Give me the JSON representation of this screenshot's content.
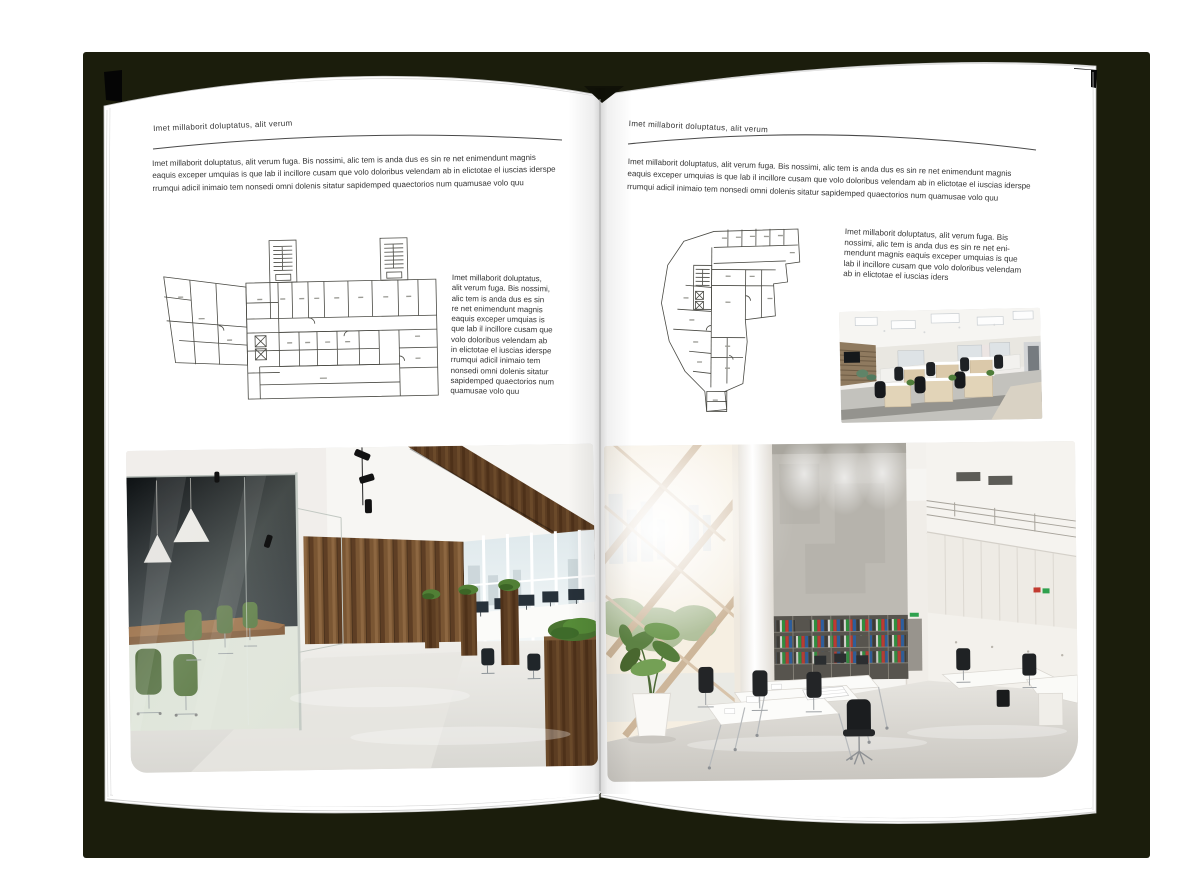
{
  "document": {
    "type": "magazine-spread-mockup",
    "backdrop_color": "#1b1d0c",
    "page_color": "#ffffff"
  },
  "left_page": {
    "kicker": "Imet millaborit doluptatus, alit verum",
    "intro_lines": [
      "Imet millaborit doluptatus, alit verum fuga. Bis nossimi, alic tem is anda dus es sin re net enimendunt magnis",
      "eaquis exceper umquias is que lab il incillore cusam que volo doloribus velendam ab in elictotae el iuscias iderspe",
      "rrumqui adicil inimaio tem nonsedi omni dolenis sitatur sapidemped quaectorios num quamusae volo quu"
    ],
    "side_lines": [
      "Imet millaborit doluptatus,",
      "alit verum fuga. Bis nossimi,",
      "alic tem is anda dus es sin",
      "re net enimendunt magnis",
      "eaquis exceper umquias is",
      "que lab il incillore cusam que",
      "volo doloribus velendam ab",
      "in elictotae el iuscias iderspe",
      "rrumqui adicil inimaio tem",
      "nonsedi omni dolenis sitatur",
      "sapidemped quaectorios num",
      "quamusae volo quu"
    ]
  },
  "right_page": {
    "kicker": "Imet millaborit doluptatus, alit verum",
    "intro_lines": [
      "Imet millaborit doluptatus, alit verum fuga. Bis nossimi, alic tem is anda dus es sin re net enimendunt magnis",
      "eaquis exceper umquias is que lab il incillore cusam que volo doloribus velendam ab in elictotae el iuscias iderspe",
      "rrumqui adicil inimaio tem nonsedi omni dolenis sitatur sapidemped quaectorios num quamusae volo quu"
    ],
    "side_lines": [
      "Imet millaborit doluptatus, alit verum fuga. Bis",
      "nossimi, alic tem is anda dus es sin re net eni-",
      "mendunt magnis eaquis exceper umquias is que",
      "lab il incillore cusam que volo doloribus velendam",
      "ab in elictotae el iuscias iders"
    ]
  },
  "figures": {
    "left_floor_plan": "office-building-floor-plan",
    "right_floor_plan": "office-building-floor-plan",
    "left_photo": "loft-office-interior-photo",
    "right_photo": "atrium-office-interior-photo",
    "small_photo": "open-plan-workstations-photo"
  }
}
